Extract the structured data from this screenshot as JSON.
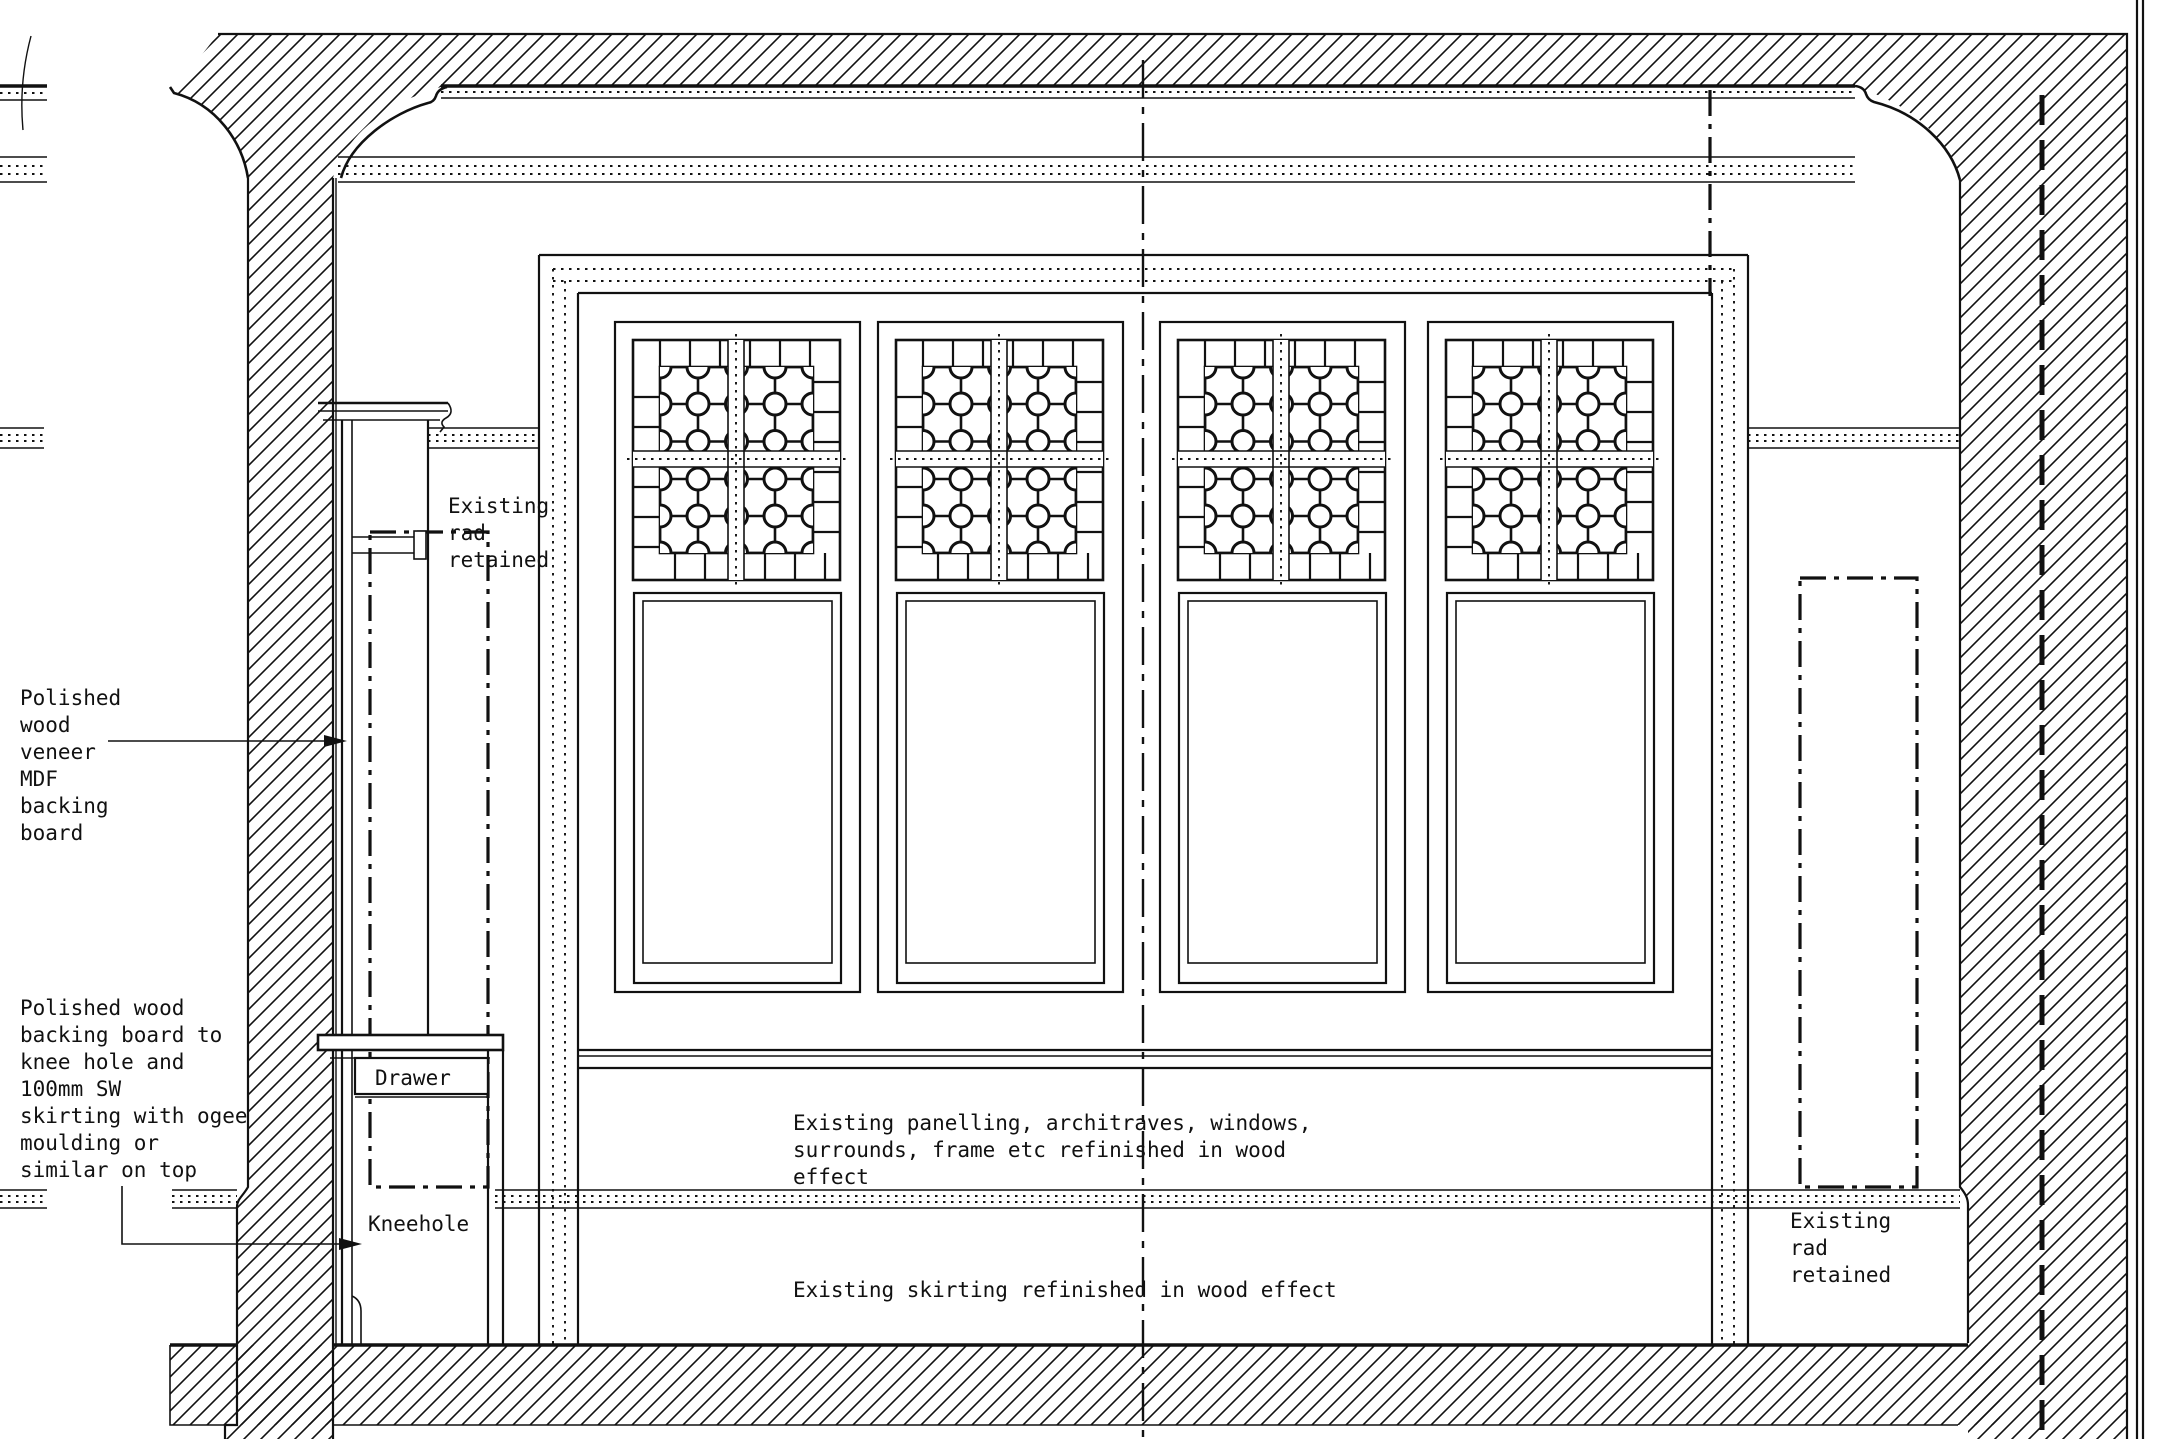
{
  "title": "Wall elevation section drawing",
  "colors": {
    "ink": "#111111",
    "paper": "#ffffff"
  },
  "annotations": {
    "veneer": {
      "lines": [
        "Polished",
        "wood",
        "veneer",
        "MDF",
        "backing",
        "board"
      ]
    },
    "backing": {
      "lines": [
        "Polished wood",
        "backing board to",
        "knee hole and",
        "100mm SW",
        "skirting with ogee",
        "moulding or",
        "similar on top"
      ]
    },
    "rad_left": {
      "lines": [
        "Existing",
        "rad",
        "retained"
      ]
    },
    "rad_right": {
      "lines": [
        "Existing",
        "rad",
        "retained"
      ]
    },
    "drawer": {
      "label": "Drawer"
    },
    "kneehole": {
      "label": "Kneehole"
    },
    "panelling": {
      "lines": [
        "Existing panelling, architraves, windows,",
        "surrounds, frame etc refinished in wood",
        "effect"
      ]
    },
    "skirting": {
      "label": "Existing skirting refinished in wood effect"
    }
  }
}
